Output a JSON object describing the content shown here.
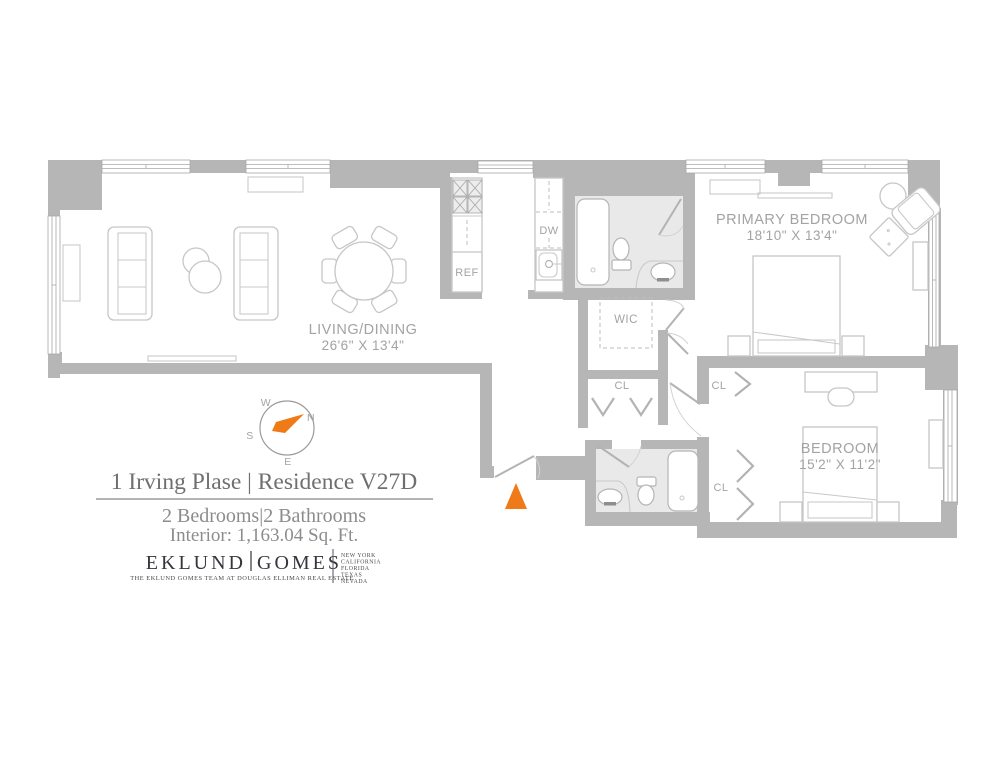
{
  "plan": {
    "labels": {
      "living_name": "LIVING/DINING",
      "living_dims": "26'6\" X 13'4\"",
      "primary_name": "PRIMARY BEDROOM",
      "primary_dims": "18'10\" X 13'4\"",
      "bedroom_name": "BEDROOM",
      "bedroom_dims": "15'2\" X 11'2\"",
      "wic": "WIC",
      "closet_hall": "CL",
      "closet_bedroom_upper": "CL",
      "closet_bedroom_lower": "CL",
      "dishwasher": "DW",
      "refrigerator": "REF"
    },
    "compass": {
      "north": "N",
      "south": "S",
      "east": "E",
      "west": "W"
    },
    "colors": {
      "wall_gray": "#b6b6b6",
      "bath_floor_gray": "#e9e9e9",
      "accent_orange": "#ee7b17",
      "furniture_line": "#c6c6c6",
      "label_gray": "#a3a3a3"
    }
  },
  "info": {
    "title": "1 Irving Plase | Residence V27D",
    "beds_baths": "2 Bedrooms|2 Bathrooms",
    "interior": "Interior: 1,163.04 Sq. Ft."
  },
  "brand": {
    "name_left": "EKLUND",
    "name_right": "GOMES",
    "tagline": "THE EKLUND GOMES TEAM AT DOUGLAS ELLIMAN REAL ESTATE",
    "states": [
      "NEW YORK",
      "CALIFORNIA",
      "FLORIDA",
      "TEXAS",
      "NEVADA"
    ]
  }
}
